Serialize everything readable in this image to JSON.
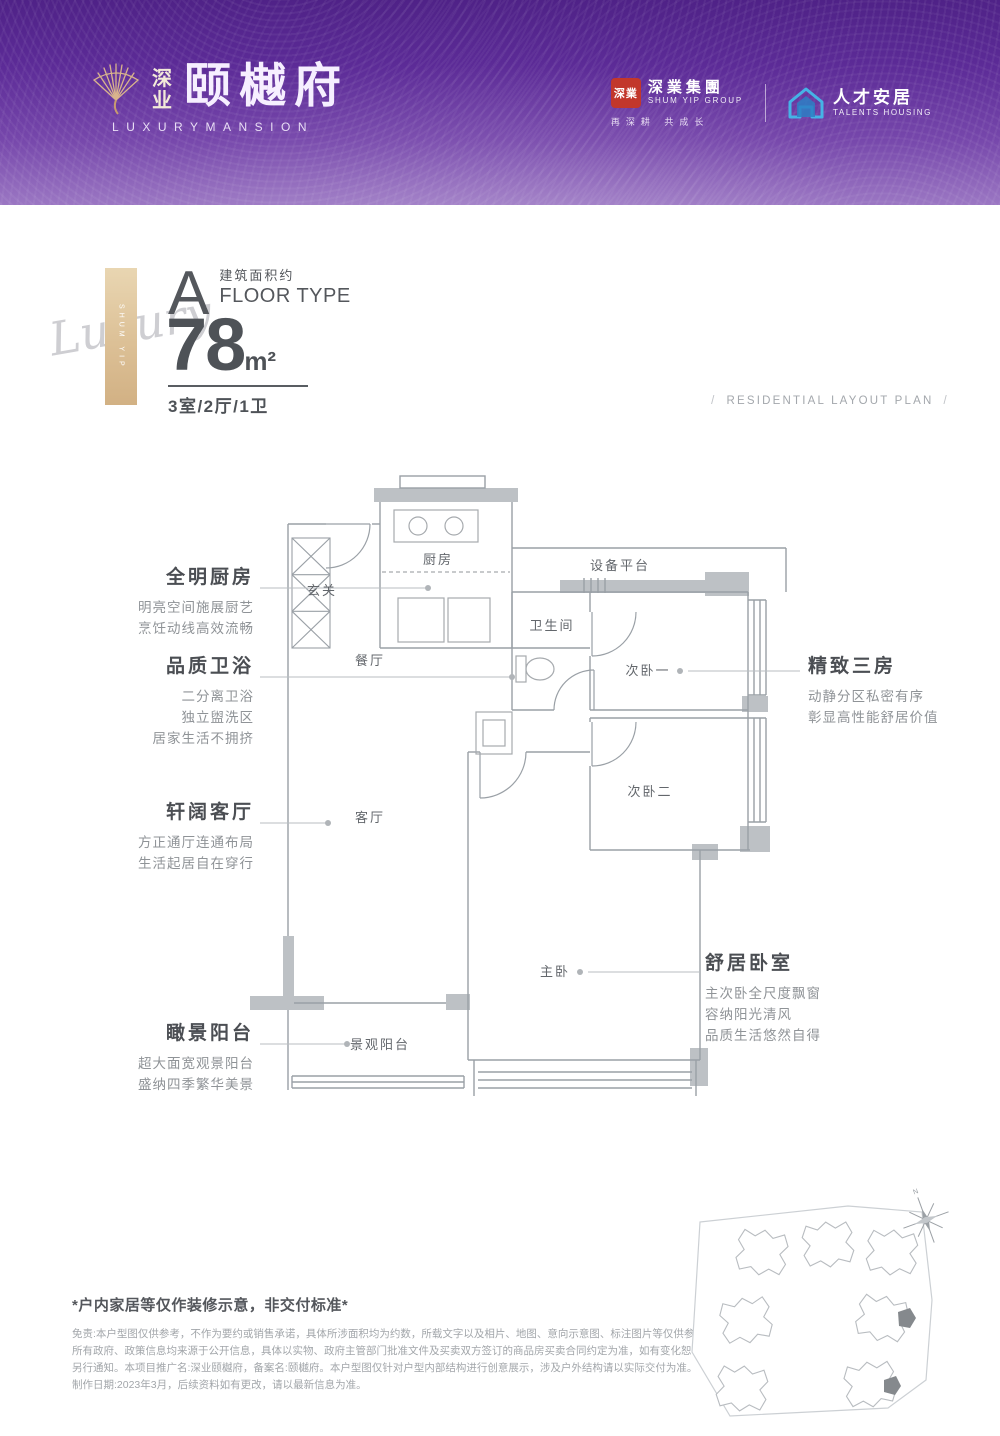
{
  "header": {
    "brand": {
      "logo_icon": "gold-fan-icon",
      "cn_small": "深业",
      "cn_large": "颐樾府",
      "en": "LUXURYMANSION"
    },
    "partners": {
      "shumyip": {
        "seal_text": "深業",
        "name_cn": "深業集團",
        "name_en": "SHUM YIP GROUP",
        "slogan": "再深耕 共成长"
      },
      "talents": {
        "icon": "blue-house-icon",
        "name_cn": "人才安居",
        "name_en": "TALENTS HOUSING"
      }
    }
  },
  "floor_type": {
    "side_tag": "SHUM YIP",
    "script_word": "Luxury",
    "letter": "A",
    "area_label_cn": "建筑面积约",
    "area_label_en": "FLOOR TYPE",
    "area_value": "78",
    "area_unit": "m²",
    "layout": "3室/2厅/1卫"
  },
  "plan_header": {
    "slash": "/",
    "caption": "RESIDENTIAL LAYOUT PLAN"
  },
  "rooms": [
    {
      "label": "玄关"
    },
    {
      "label": "厨房"
    },
    {
      "label": "设备平台"
    },
    {
      "label": "卫生间"
    },
    {
      "label": "次卧一"
    },
    {
      "label": "餐厅"
    },
    {
      "label": "次卧二"
    },
    {
      "label": "客厅"
    },
    {
      "label": "主卧"
    },
    {
      "label": "景观阳台"
    }
  ],
  "annotations": [
    {
      "title": "全明厨房",
      "lines": [
        "明亮空间施展厨艺",
        "烹饪动线高效流畅"
      ]
    },
    {
      "title": "品质卫浴",
      "lines": [
        "二分离卫浴",
        "独立盥洗区",
        "居家生活不拥挤"
      ]
    },
    {
      "title": "轩阔客厅",
      "lines": [
        "方正通厅连通布局",
        "生活起居自在穿行"
      ]
    },
    {
      "title": "瞰景阳台",
      "lines": [
        "超大面宽观景阳台",
        "盛纳四季繁华美景"
      ]
    },
    {
      "title": "精致三房",
      "lines": [
        "动静分区私密有序",
        "彰显高性能舒居价值"
      ]
    },
    {
      "title": "舒居卧室",
      "lines": [
        "主次卧全尺度飘窗",
        "容纳阳光清风",
        "品质生活悠然自得"
      ]
    }
  ],
  "disclaimer": {
    "title": "*户内家居等仅作装修示意，非交付标准*",
    "lines": [
      "免责:本户型图仅供参考，不作为要约或销售承诺，具体所涉面积均为约数，所载文字以及相片、地图、意向示意图、标注图片等仅供参考",
      "所有政府、政策信息均来源于公开信息，具体以实物、政府主管部门批准文件及买卖双方签订的商品房买卖合同约定为准，如有变化恕不",
      "另行通知。本项目推广名:深业颐樾府，备案名:颐樾府。本户型图仅针对户型内部结构进行创意展示，涉及户外结构请以实际交付为准。",
      "制作日期:2023年3月，后续资料如有更改，请以最新信息为准。"
    ]
  },
  "site_plan": {
    "compass_label": "N",
    "buildings": 7,
    "highlight_color": "#85898d"
  },
  "colors": {
    "header_purple_dark": "#4f2287",
    "header_purple_light": "#9b77c3",
    "gold": "#dcc096",
    "seal_red": "#c2372b",
    "talents_blue": "#3fa9e0",
    "wall_line": "#9aa0a6",
    "wall_fill": "#bdc1c5",
    "text_dark": "#4b4e53",
    "text_muted": "#8f9397"
  }
}
